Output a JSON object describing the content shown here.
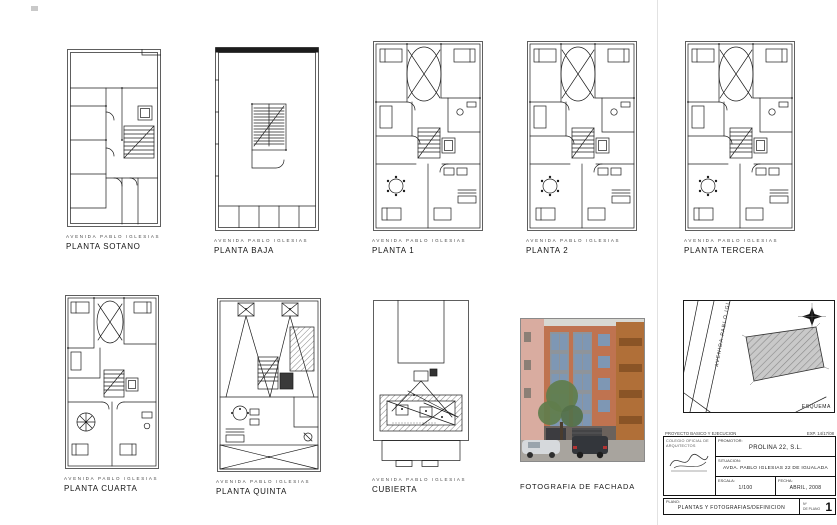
{
  "sheet": {
    "background": "#ffffff"
  },
  "plans": [
    {
      "id": "sotano",
      "street": "AVENIDA PABLO IGLESIAS",
      "title": "PLANTA SOTANO"
    },
    {
      "id": "baja",
      "street": "AVENIDA PABLO IGLESIAS",
      "title": "PLANTA BAJA"
    },
    {
      "id": "planta1",
      "street": "AVENIDA PABLO IGLESIAS",
      "title": "PLANTA 1"
    },
    {
      "id": "planta2",
      "street": "AVENIDA PABLO IGLESIAS",
      "title": "PLANTA 2"
    },
    {
      "id": "tercera",
      "street": "AVENIDA PABLO IGLESIAS",
      "title": "PLANTA TERCERA"
    },
    {
      "id": "cuarta",
      "street": "AVENIDA PABLO IGLESIAS",
      "title": "PLANTA CUARTA"
    },
    {
      "id": "quinta",
      "street": "AVENIDA PABLO IGLESIAS",
      "title": "PLANTA QUINTA"
    },
    {
      "id": "cubierta",
      "street": "AVENIDA PABLO IGLESIAS",
      "title": "CUBIERTA"
    }
  ],
  "photo": {
    "caption": "FOTOGRAFIA DE FACHADA",
    "colors": {
      "facade_brick": "#bf7350",
      "window_frame": "#8e949b",
      "glass": "#7e97b4",
      "left_building": "#d9aca0",
      "right_building": "#b06f38",
      "tree": "#5f7d4c"
    }
  },
  "map": {
    "street": "AVENIDA PABLO IGLESIAS",
    "corner_label": "ESQUEMA",
    "north_icon": "north-star-icon"
  },
  "title_block": {
    "top_left": "PROYECTO BASICO Y EJECUCION",
    "top_right": "EXP. 14/17/08",
    "promoter_label": "PROMOTOR:",
    "promoter": "PROLINA 22, S.L.",
    "location_label": "SITUACION:",
    "location": "AVDA. PABLO IGLESIAS 22 DE IGUALADA",
    "scale_label": "ESCALA:",
    "scale": "1/100",
    "date_label": "FECHA:",
    "date": "ABRIL, 2008",
    "stamp_lines": [
      "COLEGIO OFICIAL DE",
      "ARQUITECTOS"
    ],
    "drawing_label": "PLANO:",
    "drawing_title": "PLANTAS Y FOTOGRAFIAS/DEFINICION",
    "sheet_no_label_1": "Nº",
    "sheet_no_label_2": "DE PLANO",
    "sheet_number": "1"
  }
}
